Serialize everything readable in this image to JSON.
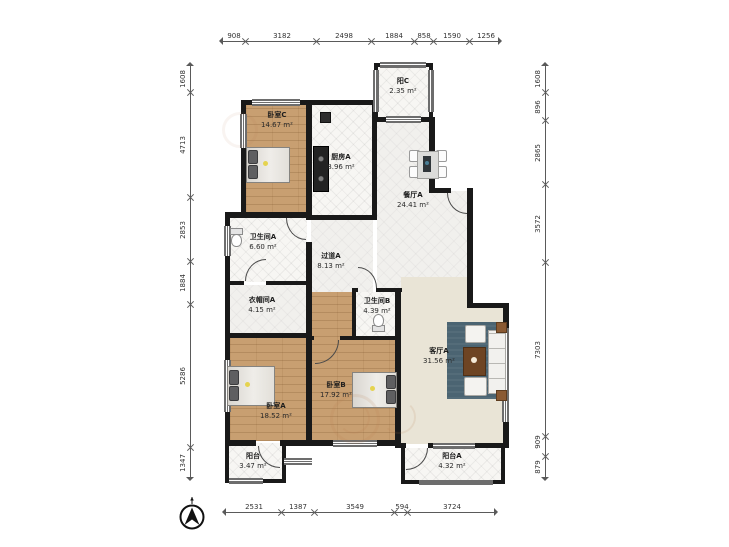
{
  "dimensions": {
    "top": [
      "908",
      "3182",
      "2498",
      "1884",
      "858",
      "1590",
      "1256"
    ],
    "bottom": [
      "2531",
      "1387",
      "3549",
      "594",
      "3724"
    ],
    "left": [
      "1608",
      "4713",
      "2853",
      "1884",
      "5286",
      "1347"
    ],
    "right": [
      "1608",
      "896",
      "2865",
      "3572",
      "7303",
      "909",
      "879"
    ]
  },
  "rooms": {
    "bedroom_c": {
      "name": "卧室C",
      "area": "14.67 m²"
    },
    "kitchen_a": {
      "name": "厨房A",
      "area": "8.96 m²"
    },
    "balcony_c": {
      "name": "阳C",
      "area": "2.35 m²"
    },
    "dining_a": {
      "name": "餐厅A",
      "area": "24.41 m²"
    },
    "bath_a": {
      "name": "卫生间A",
      "area": "6.60 m²"
    },
    "hallway_a": {
      "name": "过道A",
      "area": "8.13 m²"
    },
    "closet_a": {
      "name": "衣帽间A",
      "area": "4.15 m²"
    },
    "bath_b": {
      "name": "卫生间B",
      "area": "4.39 m²"
    },
    "living_a": {
      "name": "客厅A",
      "area": "31.56 m²"
    },
    "bedroom_b": {
      "name": "卧室B",
      "area": "17.92 m²"
    },
    "bedroom_a": {
      "name": "卧室A",
      "area": "18.52 m²"
    },
    "balcony": {
      "name": "阳台",
      "area": "3.47 m²"
    },
    "balcony_a": {
      "name": "阳台A",
      "area": "4.32 m²"
    }
  },
  "icons": {
    "compass": "north-arrow-icon",
    "watermark": "circular-logo-watermark"
  },
  "colors": {
    "wall": "#191919",
    "wood_floor": "#c89f71",
    "tile_floor": "#f7f6f3",
    "living_floor": "#e9e4d6",
    "rug": "#4b6472",
    "dimension_text": "#333333"
  }
}
